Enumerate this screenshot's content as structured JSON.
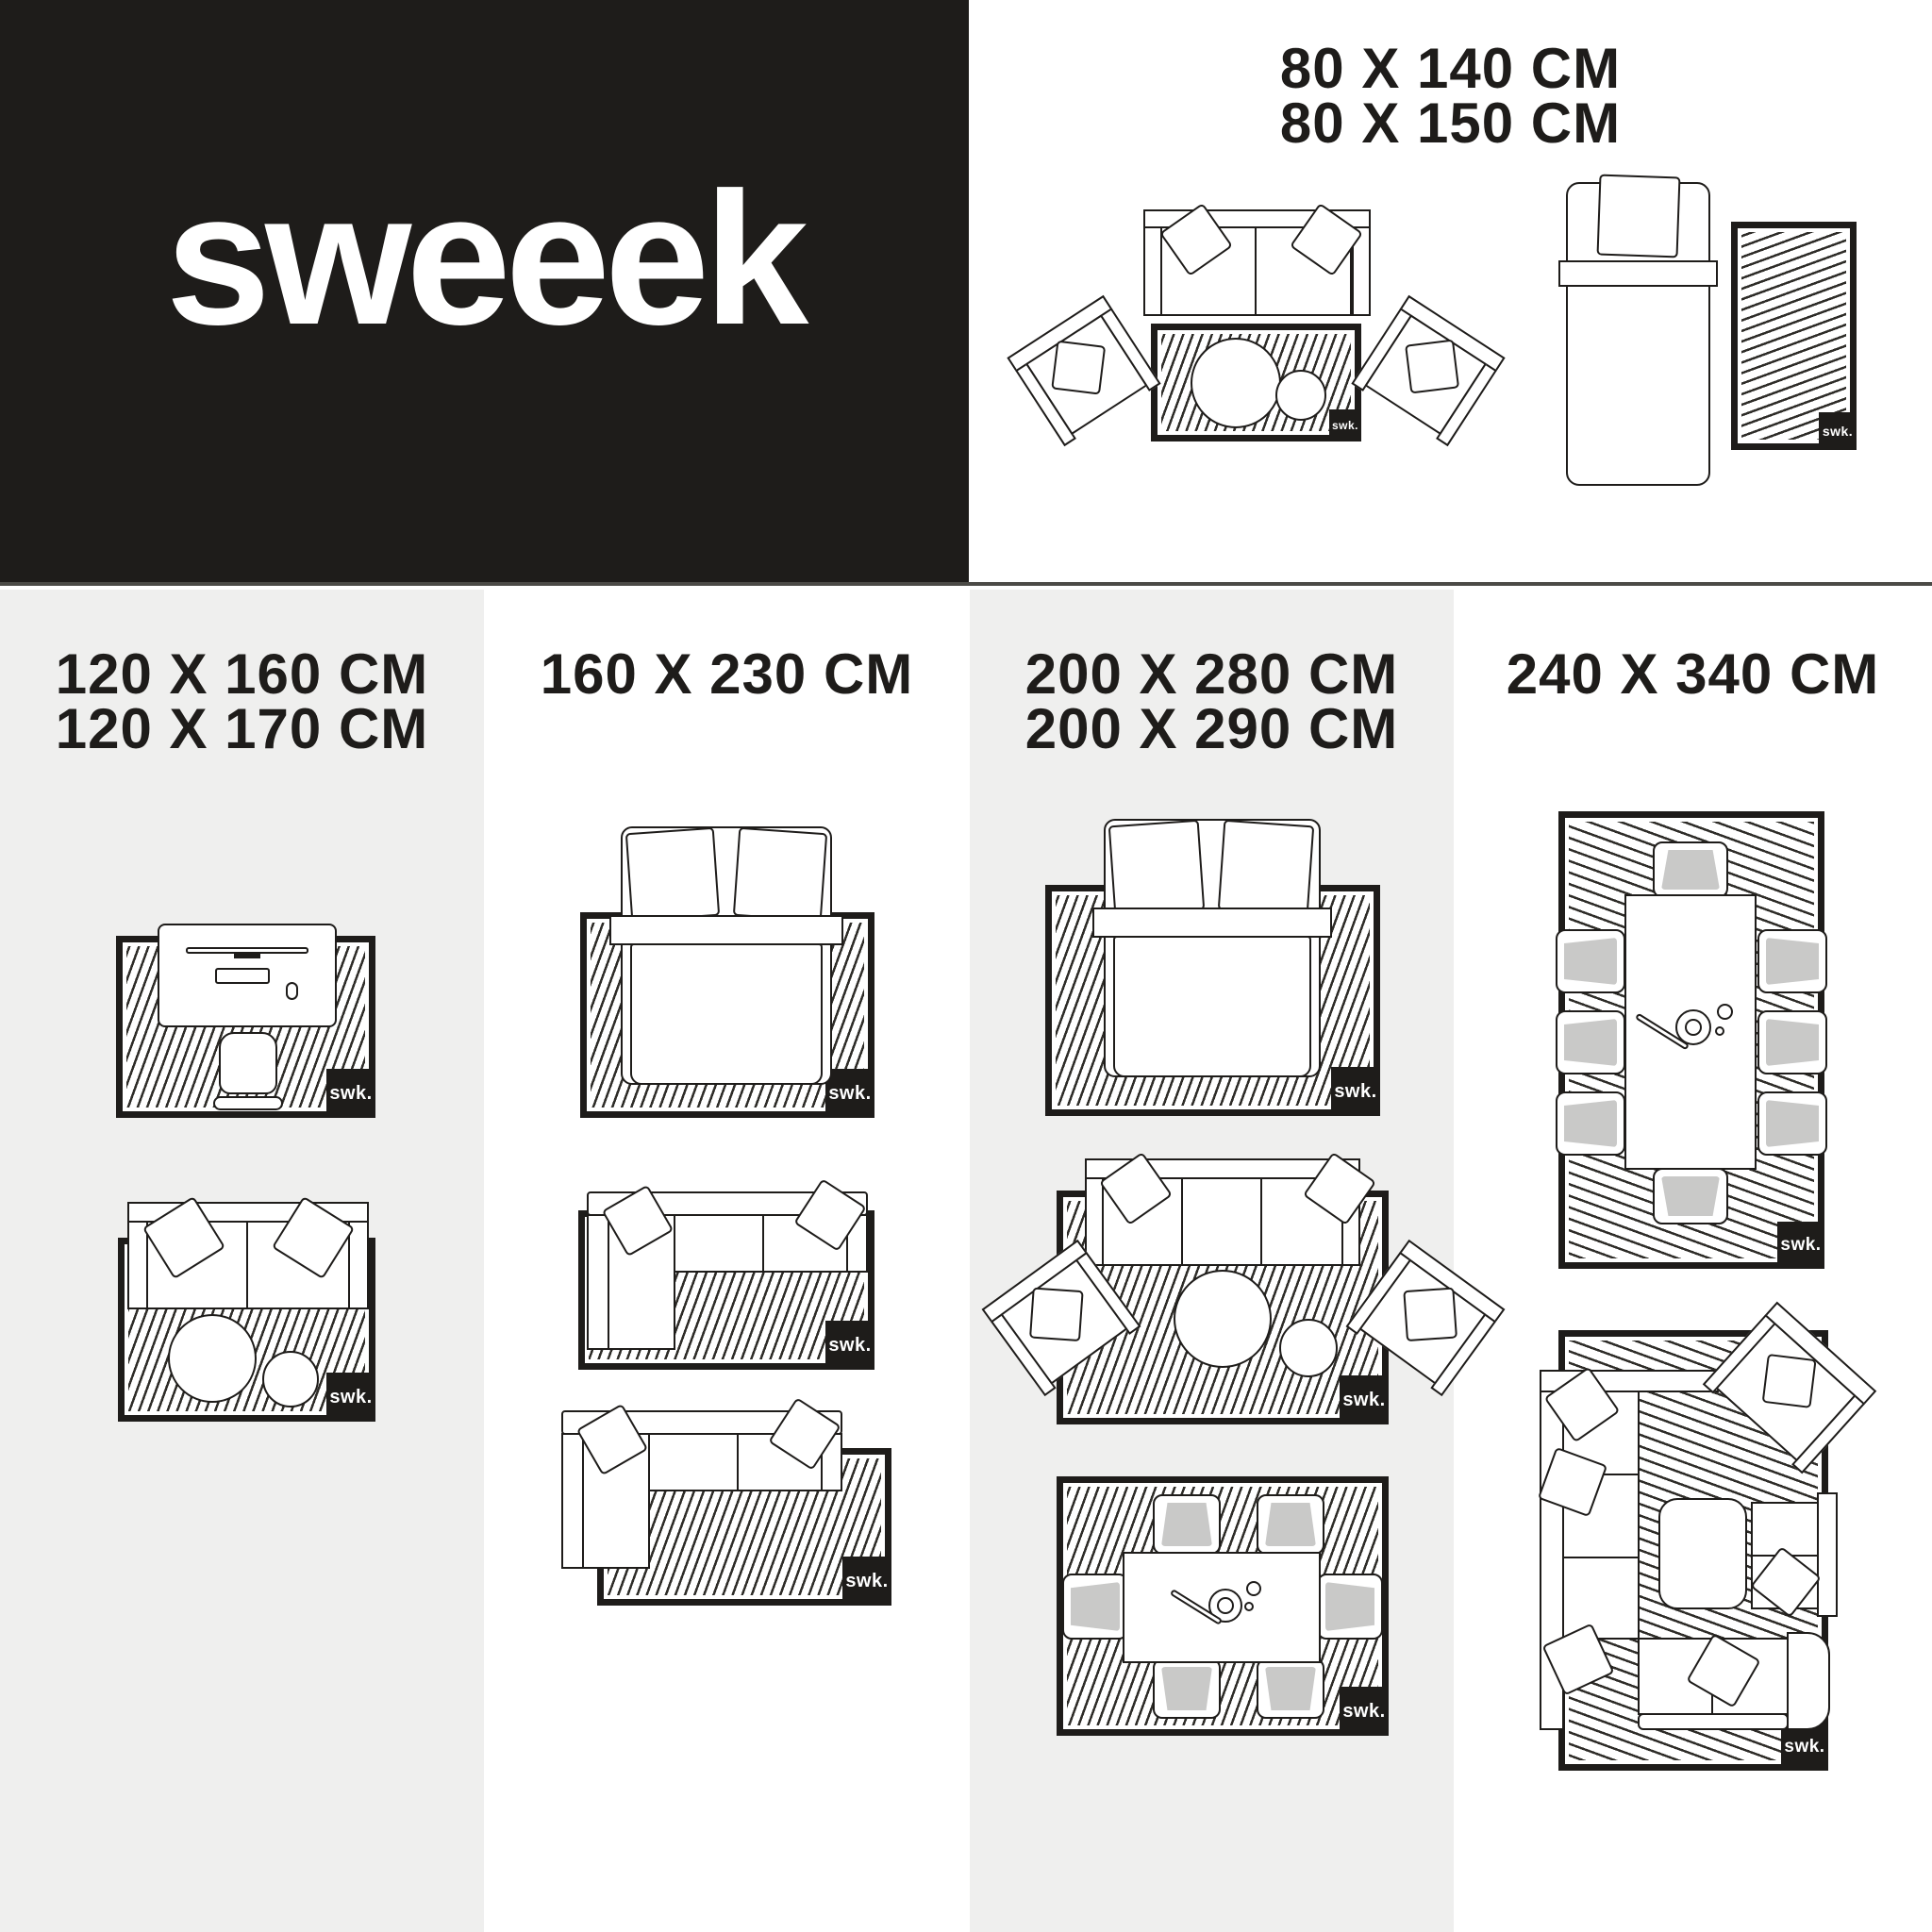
{
  "brand": {
    "logo": "sweeek",
    "mark": "swk."
  },
  "colors": {
    "black": "#1e1c1a",
    "panel_gray": "#efefee",
    "line": "#2e2c28",
    "cushion_gray": "#c9c9c8",
    "white": "#ffffff"
  },
  "top_section": {
    "sizes": [
      "80 X 140 CM",
      "80 X 150 CM"
    ],
    "scenes": [
      {
        "name": "sofa-with-two-armchairs-and-coffee-tables-on-rug"
      },
      {
        "name": "single-bed-with-bedside-rug"
      }
    ]
  },
  "columns": [
    {
      "background": "gray",
      "sizes": [
        "120 X 160 CM",
        "120 X 170 CM"
      ],
      "scenes": [
        {
          "name": "desk-with-chair-on-rug"
        },
        {
          "name": "two-seater-sofa-with-coffee-tables-on-rug"
        }
      ]
    },
    {
      "background": "white",
      "sizes": [
        "160 X 230 CM"
      ],
      "scenes": [
        {
          "name": "double-bed-on-rug"
        },
        {
          "name": "corner-sofa-fully-on-rug"
        },
        {
          "name": "corner-sofa-offset-from-rug"
        }
      ]
    },
    {
      "background": "gray",
      "sizes": [
        "200 X 280 CM",
        "200 X 290 CM"
      ],
      "scenes": [
        {
          "name": "double-bed-on-large-rug"
        },
        {
          "name": "sofa-two-armchairs-coffee-tables-on-rug"
        },
        {
          "name": "dining-table-six-chairs-on-rug"
        }
      ]
    },
    {
      "background": "white",
      "sizes": [
        "240 X 340 CM"
      ],
      "scenes": [
        {
          "name": "dining-table-eight-chairs-on-rug"
        },
        {
          "name": "lounge-corner-sofa-set-on-rug"
        }
      ]
    }
  ]
}
